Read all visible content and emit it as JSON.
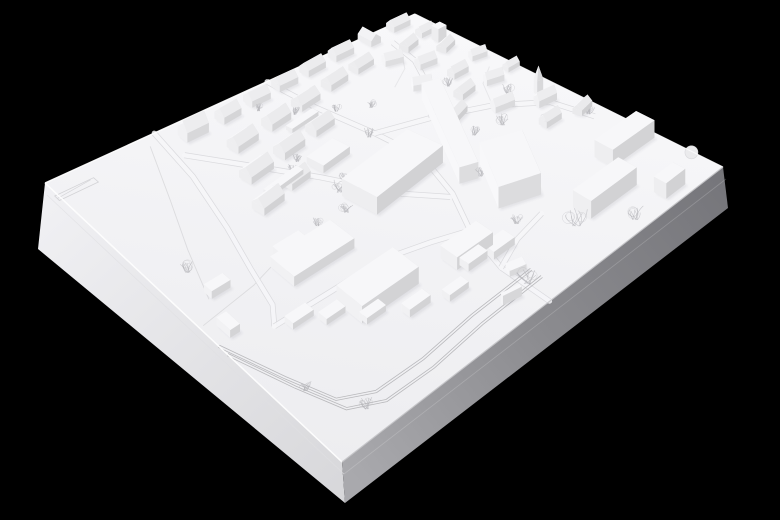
{
  "scene": {
    "alt_text": "White architectural massing model of a town district photographed on a black background, viewed from above at an angle; gabled houses along the top edge, large flat-roof buildings in the centre, a village with a church on the right, industrial sheds and a railway along the lower left, and empty fields on the left.",
    "background": "#000000",
    "plate": {
      "corners": {
        "w": [
          45,
          183
        ],
        "n": [
          415,
          14
        ],
        "e": [
          723,
          167
        ],
        "s": [
          342,
          462
        ]
      },
      "bottoms": {
        "w": [
          38,
          249
        ],
        "s": [
          345,
          503
        ],
        "e": [
          728,
          208
        ]
      },
      "height_factor": 1.25,
      "top_gradient": [
        "#f8f8fa",
        "#ededf0"
      ],
      "sw_face_gradient": [
        "#f1f1f4",
        "#d7d7da"
      ],
      "se_face_gradient": [
        "#a9a9ad",
        "#8b8b8f",
        "#75757a"
      ],
      "rim_light": "#ffffff",
      "rim_dark": "#c8c8cb",
      "seam": "#e0e0e3"
    },
    "palette": {
      "wall_base": 241,
      "top_gray": 247,
      "shadow": "rgba(80,80,92,0.10)",
      "road_fill": "#f6f6f8",
      "road_edge": "#d6d6d9",
      "rail": "#b2b2b6",
      "field_line": "#d8d8db",
      "contour": "#e3e3e6",
      "tree": "#b4b4b8",
      "stamp": "#cfcfd3",
      "pad_fill": "#ebebed",
      "pad_edge": "#d9d9dc"
    },
    "fields": {
      "lines": [
        [
          [
            0.26,
            0.03
          ],
          [
            0.185,
            0.19
          ],
          [
            0.12,
            0.33
          ],
          [
            0.065,
            0.47
          ]
        ],
        [
          [
            0.01,
            0.52
          ],
          [
            0.16,
            0.5
          ],
          [
            0.295,
            0.46
          ]
        ]
      ],
      "stamp": {
        "u": 0.045,
        "v": 0.05,
        "l": 0.105,
        "w": 0.016
      }
    },
    "roads": [
      [
        [
          0.6,
          0.0
        ],
        [
          0.615,
          0.14
        ],
        [
          0.645,
          0.3
        ],
        [
          0.66,
          0.44
        ],
        [
          0.625,
          0.58
        ],
        [
          0.575,
          0.7
        ],
        [
          0.545,
          0.84
        ],
        [
          0.545,
          1.0
        ]
      ],
      [
        [
          0.295,
          0.0
        ],
        [
          0.27,
          0.16
        ],
        [
          0.225,
          0.33
        ],
        [
          0.185,
          0.46
        ],
        [
          0.155,
          0.57
        ],
        [
          0.12,
          0.62
        ]
      ],
      [
        [
          0.3,
          0.095
        ],
        [
          0.38,
          0.2
        ],
        [
          0.47,
          0.335
        ],
        [
          0.555,
          0.5
        ],
        [
          0.615,
          0.585
        ]
      ],
      [
        [
          0.645,
          0.3
        ],
        [
          0.76,
          0.345
        ],
        [
          0.87,
          0.41
        ],
        [
          0.95,
          0.5
        ],
        [
          0.97,
          0.62
        ]
      ],
      [
        [
          0.76,
          0.345
        ],
        [
          0.83,
          0.25
        ],
        [
          0.875,
          0.15
        ],
        [
          0.89,
          0.06
        ]
      ],
      [
        [
          0.12,
          0.62
        ],
        [
          0.26,
          0.625
        ],
        [
          0.4,
          0.63
        ],
        [
          0.5,
          0.665
        ],
        [
          0.575,
          0.7
        ]
      ],
      [
        [
          0.545,
          0.84
        ],
        [
          0.62,
          0.8
        ],
        [
          0.7,
          0.78
        ]
      ]
    ],
    "railway": {
      "tracks": [
        [
          [
            0.0,
            0.615
          ],
          [
            0.05,
            0.78
          ],
          [
            0.09,
            0.9
          ],
          [
            0.16,
            0.945
          ],
          [
            0.28,
            0.95
          ],
          [
            0.42,
            0.935
          ],
          [
            0.58,
            0.93
          ]
        ],
        [
          [
            0.0,
            0.585
          ],
          [
            0.05,
            0.745
          ],
          [
            0.09,
            0.865
          ],
          [
            0.16,
            0.91
          ],
          [
            0.28,
            0.915
          ],
          [
            0.42,
            0.9
          ],
          [
            0.58,
            0.895
          ]
        ]
      ]
    },
    "contours": [
      [
        [
          0.87,
          0.41
        ],
        [
          0.91,
          0.33
        ],
        [
          0.96,
          0.29
        ]
      ],
      [
        [
          0.78,
          0.2
        ],
        [
          0.84,
          0.16
        ],
        [
          0.88,
          0.1
        ]
      ]
    ],
    "pad": {
      "u": 0.998,
      "v": 0.9,
      "r": 6.5
    },
    "buildings": [
      [
        0.36,
        0.05,
        0.058,
        0.032,
        0,
        0.03,
        "g"
      ],
      [
        0.455,
        0.048,
        0.05,
        0.03,
        -5,
        0.022,
        "g"
      ],
      [
        0.54,
        0.04,
        0.05,
        0.03,
        0,
        0.02,
        "g"
      ],
      [
        0.62,
        0.034,
        0.05,
        0.028,
        0,
        0.02,
        "g"
      ],
      [
        0.7,
        0.028,
        0.05,
        0.028,
        -5,
        0.02,
        "g"
      ],
      [
        0.78,
        0.024,
        0.048,
        0.028,
        0,
        0.02,
        "g"
      ],
      [
        0.86,
        0.02,
        0.044,
        0.026,
        90,
        0.018,
        "g"
      ],
      [
        0.94,
        0.018,
        0.044,
        0.026,
        0,
        0.018,
        "g"
      ],
      [
        0.965,
        0.12,
        0.022,
        0.022,
        0,
        0.026,
        "f"
      ],
      [
        0.42,
        0.14,
        0.062,
        0.034,
        -8,
        0.022,
        "g"
      ],
      [
        0.52,
        0.128,
        0.058,
        0.032,
        -8,
        0.022,
        "g"
      ],
      [
        0.61,
        0.115,
        0.056,
        0.032,
        -8,
        0.02,
        "g"
      ],
      [
        0.7,
        0.1,
        0.052,
        0.03,
        -8,
        0.02,
        "g"
      ],
      [
        0.78,
        0.09,
        0.048,
        0.028,
        -8,
        0.018,
        "g"
      ],
      [
        0.38,
        0.235,
        0.068,
        0.036,
        -8,
        0.022,
        "g"
      ],
      [
        0.48,
        0.22,
        0.062,
        0.034,
        -8,
        0.022,
        "g"
      ],
      [
        0.575,
        0.205,
        0.056,
        0.032,
        -8,
        0.02,
        "g"
      ],
      [
        0.335,
        0.33,
        0.062,
        0.036,
        -8,
        0.022,
        "g"
      ],
      [
        0.425,
        0.31,
        0.056,
        0.032,
        -8,
        0.02,
        "g"
      ],
      [
        0.4,
        0.3,
        0.1,
        0.02,
        -8,
        0.009,
        "f"
      ],
      [
        0.56,
        0.165,
        0.08,
        0.018,
        -8,
        0.008,
        "f"
      ],
      [
        0.52,
        0.3,
        0.08,
        0.048,
        -8,
        0.014,
        "f"
      ],
      [
        0.57,
        0.45,
        0.2,
        0.1,
        -8,
        0.032,
        "f"
      ],
      [
        0.74,
        0.43,
        0.32,
        0.04,
        115,
        0.03,
        "f"
      ],
      [
        0.73,
        0.64,
        0.16,
        0.09,
        115,
        0.038,
        "f"
      ],
      [
        0.3,
        0.52,
        0.16,
        0.08,
        0,
        0.018,
        "f"
      ],
      [
        0.265,
        0.5,
        0.07,
        0.05,
        0,
        0.03,
        "f"
      ],
      [
        0.33,
        0.7,
        0.15,
        0.085,
        0,
        0.03,
        "f"
      ],
      [
        0.095,
        0.46,
        0.05,
        0.026,
        0,
        0.014,
        "f"
      ],
      [
        0.045,
        0.56,
        0.026,
        0.046,
        0,
        0.014,
        "f"
      ],
      [
        0.17,
        0.64,
        0.055,
        0.028,
        0,
        0.011,
        "f"
      ],
      [
        0.225,
        0.68,
        0.05,
        0.028,
        0,
        0.011,
        "f"
      ],
      [
        0.285,
        0.74,
        0.05,
        0.026,
        0,
        0.011,
        "f"
      ],
      [
        0.36,
        0.79,
        0.055,
        0.028,
        0,
        0.013,
        "f"
      ],
      [
        0.44,
        0.82,
        0.05,
        0.026,
        0,
        0.011,
        "f"
      ],
      [
        0.52,
        0.78,
        0.05,
        0.03,
        0,
        0.013,
        "f"
      ],
      [
        0.53,
        0.745,
        0.095,
        0.055,
        0,
        0.022,
        "f"
      ],
      [
        0.578,
        0.79,
        0.055,
        0.038,
        0,
        0.013,
        "f"
      ],
      [
        0.56,
        0.87,
        0.036,
        0.026,
        20,
        0.01,
        "f"
      ],
      [
        0.5,
        0.93,
        0.042,
        0.01,
        15,
        0.016,
        "f"
      ],
      [
        0.84,
        0.12,
        0.04,
        0.026,
        20,
        0.018,
        "g"
      ],
      [
        0.9,
        0.1,
        0.036,
        0.024,
        -15,
        0.018,
        "g"
      ],
      [
        0.96,
        0.08,
        0.034,
        0.022,
        0,
        0.016,
        "g"
      ],
      [
        0.88,
        0.18,
        0.04,
        0.026,
        10,
        0.018,
        "g"
      ],
      [
        0.95,
        0.16,
        0.036,
        0.024,
        -20,
        0.016,
        "g"
      ],
      [
        0.82,
        0.24,
        0.04,
        0.026,
        30,
        0.018,
        "g"
      ],
      [
        0.9,
        0.26,
        0.038,
        0.024,
        0,
        0.018,
        "g"
      ],
      [
        0.97,
        0.24,
        0.034,
        0.022,
        15,
        0.016,
        "g"
      ],
      [
        0.86,
        0.33,
        0.04,
        0.026,
        -10,
        0.018,
        "g"
      ],
      [
        0.93,
        0.34,
        0.038,
        0.024,
        20,
        0.018,
        "g"
      ],
      [
        0.985,
        0.33,
        0.03,
        0.02,
        0,
        0.014,
        "g"
      ],
      [
        0.88,
        0.43,
        0.044,
        0.028,
        15,
        0.018,
        "g"
      ],
      [
        0.8,
        0.38,
        0.04,
        0.026,
        -20,
        0.018,
        "g"
      ],
      [
        0.945,
        0.49,
        0.042,
        0.024,
        10,
        0.02,
        "g"
      ],
      [
        0.958,
        0.452,
        0.014,
        0.014,
        10,
        0.026,
        "t"
      ],
      [
        0.905,
        0.555,
        0.04,
        0.026,
        0,
        0.018,
        "g"
      ],
      [
        0.97,
        0.58,
        0.036,
        0.024,
        -15,
        0.016,
        "g"
      ],
      [
        0.935,
        0.76,
        0.11,
        0.06,
        0,
        0.03,
        "f"
      ],
      [
        0.81,
        0.85,
        0.12,
        0.06,
        0,
        0.03,
        "f"
      ],
      [
        0.9,
        0.95,
        0.05,
        0.04,
        0,
        0.026,
        "f"
      ]
    ],
    "trees": [
      [
        0.08,
        0.38,
        0.018
      ],
      [
        0.12,
        0.93,
        0.016
      ],
      [
        0.06,
        0.8,
        0.013
      ],
      [
        0.4,
        0.23,
        0.012
      ],
      [
        0.44,
        0.28,
        0.011
      ],
      [
        0.5,
        0.38,
        0.013
      ],
      [
        0.53,
        0.44,
        0.012
      ],
      [
        0.47,
        0.4,
        0.02
      ],
      [
        0.44,
        0.46,
        0.016
      ],
      [
        0.52,
        0.07,
        0.01
      ],
      [
        0.57,
        0.13,
        0.011
      ],
      [
        0.64,
        0.18,
        0.011
      ],
      [
        0.47,
        0.26,
        0.011
      ],
      [
        0.63,
        0.3,
        0.014
      ],
      [
        0.7,
        0.22,
        0.012
      ],
      [
        0.8,
        0.3,
        0.016
      ],
      [
        0.86,
        0.28,
        0.013
      ],
      [
        0.92,
        0.4,
        0.014
      ],
      [
        0.84,
        0.48,
        0.016
      ],
      [
        0.78,
        0.46,
        0.013
      ],
      [
        0.7,
        0.58,
        0.014
      ],
      [
        0.9,
        0.55,
        0.014
      ],
      [
        0.97,
        0.6,
        0.013
      ],
      [
        0.55,
        0.92,
        0.022
      ],
      [
        0.72,
        0.87,
        0.028
      ],
      [
        0.8,
        0.96,
        0.018
      ],
      [
        0.65,
        0.76,
        0.013
      ],
      [
        0.37,
        0.45,
        0.012
      ]
    ]
  }
}
